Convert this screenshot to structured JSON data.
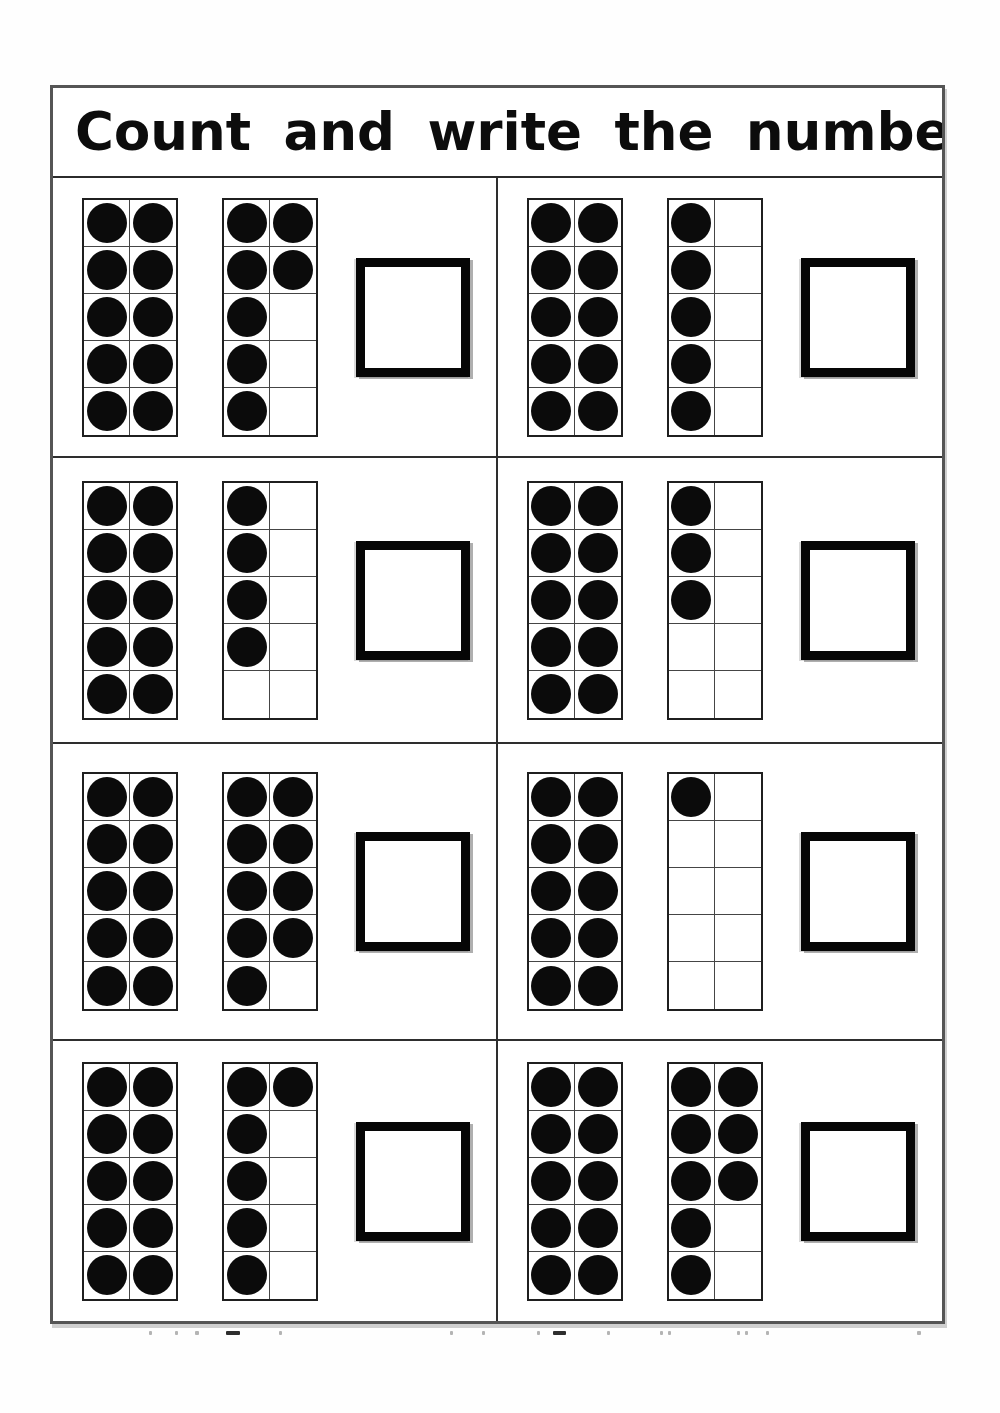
{
  "worksheet": {
    "title": "Count and write the number.",
    "colors": {
      "ink": "#0b0b0b",
      "frame_border": "#1f1f1f",
      "grid_line": "#454545",
      "table_border": "#555555",
      "answer_box_border": "#060606"
    },
    "problems": [
      {
        "id": 1,
        "frames": [
          {
            "name": "ten-frame-left",
            "cells": [
              [
                1,
                1
              ],
              [
                1,
                1
              ],
              [
                1,
                1
              ],
              [
                1,
                1
              ],
              [
                1,
                1
              ]
            ],
            "dots": 10
          },
          {
            "name": "ten-frame-right",
            "cells": [
              [
                1,
                1
              ],
              [
                1,
                1
              ],
              [
                1,
                0
              ],
              [
                1,
                0
              ],
              [
                1,
                0
              ]
            ],
            "dots": 7
          }
        ],
        "total_dots": 17,
        "answer": ""
      },
      {
        "id": 2,
        "frames": [
          {
            "name": "ten-frame-left",
            "cells": [
              [
                1,
                1
              ],
              [
                1,
                1
              ],
              [
                1,
                1
              ],
              [
                1,
                1
              ],
              [
                1,
                1
              ]
            ],
            "dots": 10
          },
          {
            "name": "ten-frame-right",
            "cells": [
              [
                1,
                0
              ],
              [
                1,
                0
              ],
              [
                1,
                0
              ],
              [
                1,
                0
              ],
              [
                1,
                0
              ]
            ],
            "dots": 5
          }
        ],
        "total_dots": 15,
        "answer": ""
      },
      {
        "id": 3,
        "frames": [
          {
            "name": "ten-frame-left",
            "cells": [
              [
                1,
                1
              ],
              [
                1,
                1
              ],
              [
                1,
                1
              ],
              [
                1,
                1
              ],
              [
                1,
                1
              ]
            ],
            "dots": 10
          },
          {
            "name": "ten-frame-right",
            "cells": [
              [
                1,
                0
              ],
              [
                1,
                0
              ],
              [
                1,
                0
              ],
              [
                1,
                0
              ],
              [
                0,
                0
              ]
            ],
            "dots": 4
          }
        ],
        "total_dots": 14,
        "answer": ""
      },
      {
        "id": 4,
        "frames": [
          {
            "name": "ten-frame-left",
            "cells": [
              [
                1,
                1
              ],
              [
                1,
                1
              ],
              [
                1,
                1
              ],
              [
                1,
                1
              ],
              [
                1,
                1
              ]
            ],
            "dots": 10
          },
          {
            "name": "ten-frame-right",
            "cells": [
              [
                1,
                0
              ],
              [
                1,
                0
              ],
              [
                1,
                0
              ],
              [
                0,
                0
              ],
              [
                0,
                0
              ]
            ],
            "dots": 3
          }
        ],
        "total_dots": 13,
        "answer": ""
      },
      {
        "id": 5,
        "frames": [
          {
            "name": "ten-frame-left",
            "cells": [
              [
                1,
                1
              ],
              [
                1,
                1
              ],
              [
                1,
                1
              ],
              [
                1,
                1
              ],
              [
                1,
                1
              ]
            ],
            "dots": 10
          },
          {
            "name": "ten-frame-right",
            "cells": [
              [
                1,
                1
              ],
              [
                1,
                1
              ],
              [
                1,
                1
              ],
              [
                1,
                1
              ],
              [
                1,
                0
              ]
            ],
            "dots": 9
          }
        ],
        "total_dots": 19,
        "answer": ""
      },
      {
        "id": 6,
        "frames": [
          {
            "name": "ten-frame-left",
            "cells": [
              [
                1,
                1
              ],
              [
                1,
                1
              ],
              [
                1,
                1
              ],
              [
                1,
                1
              ],
              [
                1,
                1
              ]
            ],
            "dots": 10
          },
          {
            "name": "ten-frame-right",
            "cells": [
              [
                1,
                0
              ],
              [
                0,
                0
              ],
              [
                0,
                0
              ],
              [
                0,
                0
              ],
              [
                0,
                0
              ]
            ],
            "dots": 1
          }
        ],
        "total_dots": 11,
        "answer": ""
      },
      {
        "id": 7,
        "frames": [
          {
            "name": "ten-frame-left",
            "cells": [
              [
                1,
                1
              ],
              [
                1,
                1
              ],
              [
                1,
                1
              ],
              [
                1,
                1
              ],
              [
                1,
                1
              ]
            ],
            "dots": 10
          },
          {
            "name": "ten-frame-right",
            "cells": [
              [
                1,
                1
              ],
              [
                1,
                0
              ],
              [
                1,
                0
              ],
              [
                1,
                0
              ],
              [
                1,
                0
              ]
            ],
            "dots": 6
          }
        ],
        "total_dots": 16,
        "answer": ""
      },
      {
        "id": 8,
        "frames": [
          {
            "name": "ten-frame-left",
            "cells": [
              [
                1,
                1
              ],
              [
                1,
                1
              ],
              [
                1,
                1
              ],
              [
                1,
                1
              ],
              [
                1,
                1
              ]
            ],
            "dots": 10
          },
          {
            "name": "ten-frame-right",
            "cells": [
              [
                1,
                1
              ],
              [
                1,
                1
              ],
              [
                1,
                1
              ],
              [
                1,
                0
              ],
              [
                1,
                0
              ]
            ],
            "dots": 8
          }
        ],
        "total_dots": 18,
        "answer": ""
      }
    ],
    "scan_specks": [
      {
        "x": 149,
        "w": 3,
        "dark": false
      },
      {
        "x": 175,
        "w": 3,
        "dark": false
      },
      {
        "x": 195,
        "w": 4,
        "dark": false
      },
      {
        "x": 226,
        "w": 14,
        "dark": true
      },
      {
        "x": 279,
        "w": 3,
        "dark": false
      },
      {
        "x": 450,
        "w": 3,
        "dark": false
      },
      {
        "x": 482,
        "w": 3,
        "dark": false
      },
      {
        "x": 537,
        "w": 3,
        "dark": false
      },
      {
        "x": 553,
        "w": 13,
        "dark": true
      },
      {
        "x": 607,
        "w": 3,
        "dark": false
      },
      {
        "x": 660,
        "w": 3,
        "dark": false
      },
      {
        "x": 668,
        "w": 3,
        "dark": false
      },
      {
        "x": 737,
        "w": 3,
        "dark": false
      },
      {
        "x": 745,
        "w": 3,
        "dark": false
      },
      {
        "x": 766,
        "w": 3,
        "dark": false
      },
      {
        "x": 917,
        "w": 4,
        "dark": false
      }
    ]
  }
}
